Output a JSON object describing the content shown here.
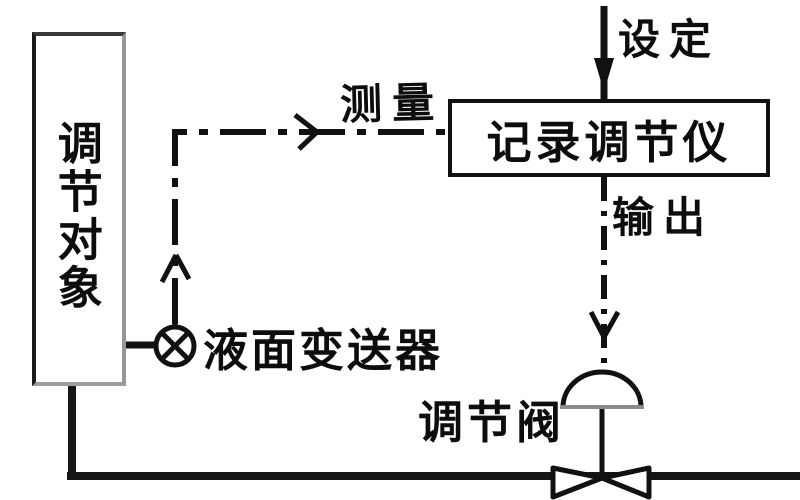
{
  "diagram": {
    "title_hint": "liquid-level control loop block diagram",
    "ink_color": "#111111",
    "background_color": "#ffffff",
    "labels": {
      "controlled_object": "调节对象",
      "measurement": "测量",
      "controller": "记录调节仪",
      "setpoint": "设定",
      "output": "输出",
      "level_transmitter": "液面变送器",
      "control_valve": "调节阀"
    }
  }
}
